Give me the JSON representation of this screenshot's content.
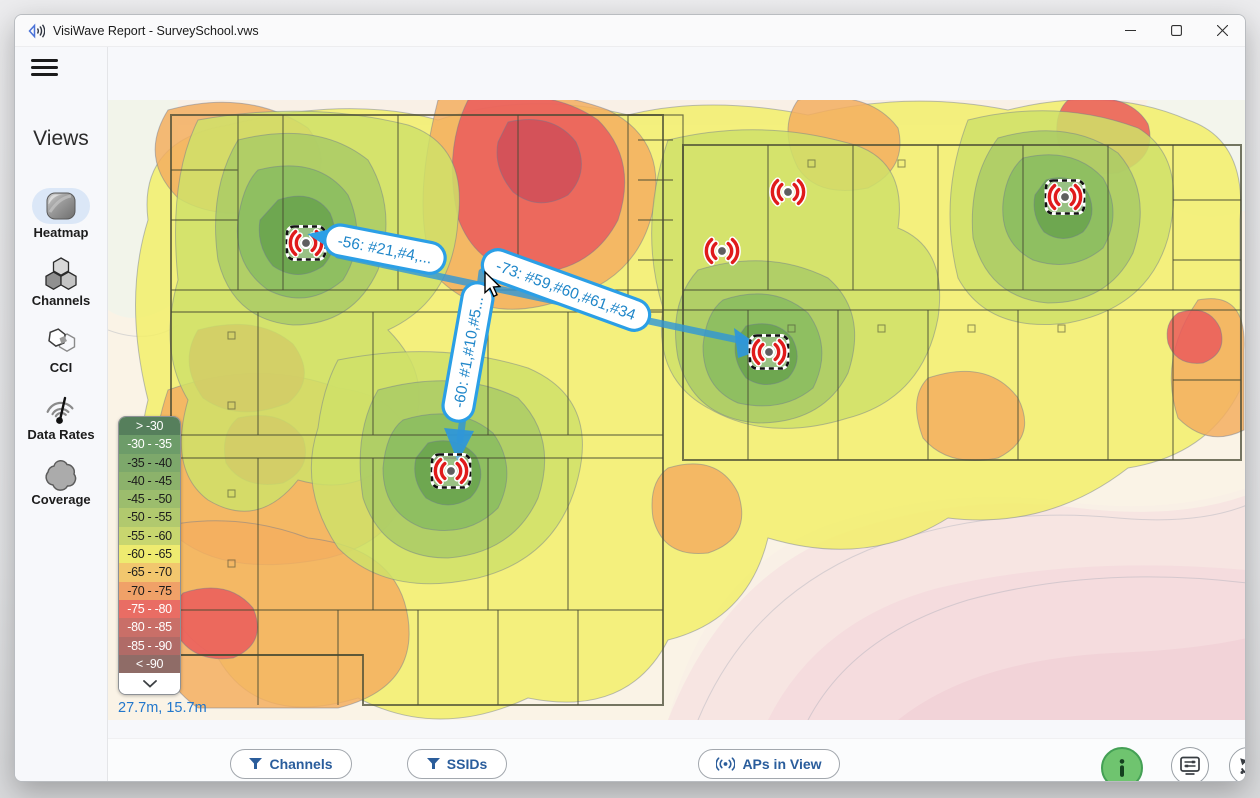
{
  "window": {
    "title": "VisiWave Report - SurveySchool.vws",
    "controls": {
      "minimize": "minimize",
      "maximize": "maximize",
      "close": "close"
    }
  },
  "sidebar": {
    "title": "Views",
    "items": [
      {
        "label": "Heatmap",
        "icon": "heatmap-icon",
        "selected": true
      },
      {
        "label": "Channels",
        "icon": "channels-icon",
        "selected": false
      },
      {
        "label": "CCI",
        "icon": "cci-icon",
        "selected": false
      },
      {
        "label": "Data Rates",
        "icon": "data-rates-icon",
        "selected": false
      },
      {
        "label": "Coverage",
        "icon": "coverage-icon",
        "selected": false
      }
    ]
  },
  "topbar": {
    "icons": [
      "help-icon",
      "gallery-icon"
    ]
  },
  "map": {
    "coordinates": "27.7m, 15.7m",
    "ap_callouts": [
      "-56: #21,#4,...",
      "-73: #59,#60,#61,#34",
      "-60: #1,#10,#5..."
    ],
    "ap_count": 6,
    "selected_ap_count": 4
  },
  "legend": {
    "rows": [
      {
        "label": "> -30",
        "bg": "#567f5c",
        "fg": "#ffffff"
      },
      {
        "label": "-30 - -35",
        "bg": "#6d9c69",
        "fg": "#ffffff"
      },
      {
        "label": "-35 - -40",
        "bg": "#7da86b",
        "fg": "#1c1c1c"
      },
      {
        "label": "-40 - -45",
        "bg": "#8cb26b",
        "fg": "#1c1c1c"
      },
      {
        "label": "-45 - -50",
        "bg": "#9cbd6d",
        "fg": "#1c1c1c"
      },
      {
        "label": "-50 - -55",
        "bg": "#b1c96e",
        "fg": "#1c1c1c"
      },
      {
        "label": "-55 - -60",
        "bg": "#c8d66f",
        "fg": "#1c1c1c"
      },
      {
        "label": "-60 - -65",
        "bg": "#eeeb70",
        "fg": "#1c1c1c"
      },
      {
        "label": "-65 - -70",
        "bg": "#f2c76e",
        "fg": "#1c1c1c"
      },
      {
        "label": "-70 - -75",
        "bg": "#f0a168",
        "fg": "#1c1c1c"
      },
      {
        "label": "-75 - -80",
        "bg": "#e96d64",
        "fg": "#ffffff"
      },
      {
        "label": "-80 - -85",
        "bg": "#c96f68",
        "fg": "#ffffff"
      },
      {
        "label": "-85 - -90",
        "bg": "#b06b67",
        "fg": "#ffffff"
      },
      {
        "label": "< -90",
        "bg": "#8f6c67",
        "fg": "#ffffff"
      }
    ]
  },
  "toolbar": {
    "channels": {
      "label": "Channels",
      "value": "2.4GHz,5GHz,6GHz",
      "icon": "filter-icon"
    },
    "ssids": {
      "label": "SSIDs",
      "value": "All",
      "icon": "filter-icon"
    },
    "aps_in_view": {
      "label": "APs in View",
      "value": "Local",
      "icon": "antenna-icon"
    },
    "wifi_probe": {
      "label": "WiFi Probe",
      "icon": "info-icon",
      "accent": "#6fc46f"
    },
    "options": {
      "label": "Options",
      "icon": "display-settings-icon"
    },
    "undo": {
      "label": "Undo",
      "icon": "undo-arrow-icon",
      "enabled": true
    },
    "redo": {
      "label": "Redo",
      "icon": "redo-arrow-icon",
      "enabled": false
    }
  },
  "colors": {
    "accent_blue": "#2e9be0",
    "callout_text": "#1f86c9",
    "ap_red": "#e01b1b",
    "probe_green": "#6fc46f"
  }
}
